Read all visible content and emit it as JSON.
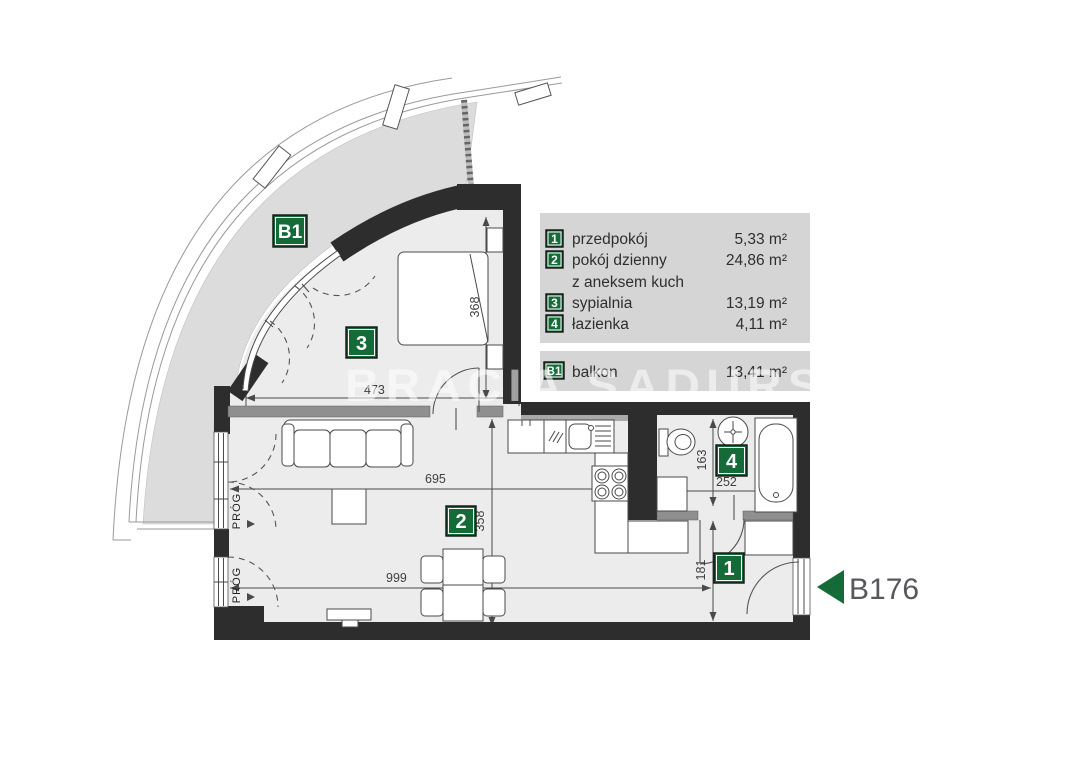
{
  "legend": {
    "rows": [
      {
        "badge": "1",
        "label": "przedpokój",
        "area": "5,33 m²"
      },
      {
        "badge": "2",
        "label": "pokój dzienny",
        "area": "24,86 m²"
      },
      {
        "badge": "",
        "label": "z aneksem kuch",
        "area": ""
      },
      {
        "badge": "3",
        "label": "sypialnia",
        "area": "13,19 m²"
      },
      {
        "badge": "4",
        "label": "łazienka",
        "area": "4,11 m²"
      }
    ],
    "balcony": {
      "badge": "B1",
      "label": "balkon",
      "area": "13,41 m²"
    }
  },
  "plan": {
    "unit_label": "B176",
    "watermark": "BRACIA SADURSCY",
    "threshold": "PRÓG",
    "badges": {
      "balcony": "B1",
      "bedroom": "3",
      "living": "2",
      "bathroom": "4",
      "hall": "1"
    },
    "dims": {
      "bedroom_width": "473",
      "bedroom_depth": "368",
      "living_width": "695",
      "living_depth": "358",
      "living_width_lower": "999",
      "bathroom_depth": "163",
      "bathroom_width": "252",
      "hall_depth": "181"
    }
  },
  "colors": {
    "accent_green": "#156b38",
    "wall": "#2d2d2d",
    "floor": "#ececec",
    "balcony_floor": "#dcdcdc",
    "legend_bg": "#d5d5d5",
    "dim_text": "#3f3f3f",
    "unit_text": "#57585c"
  }
}
